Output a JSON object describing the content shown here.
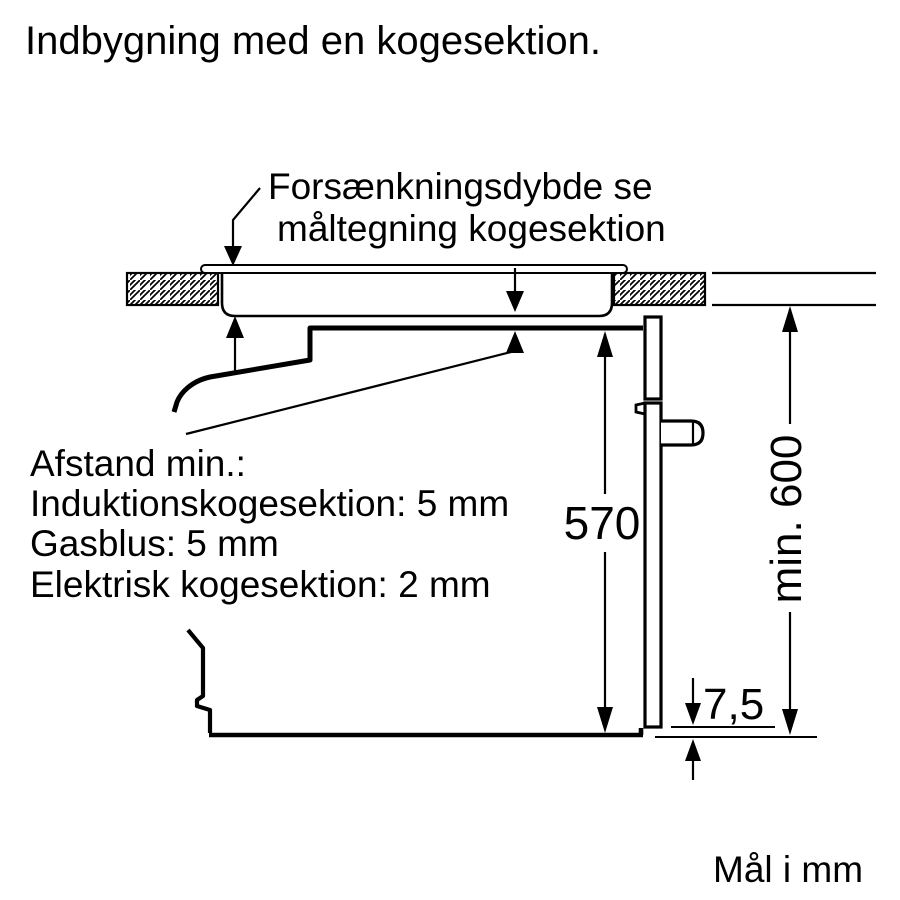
{
  "title": "Indbygning med en kogesektion.",
  "diagram": {
    "callout_recess": {
      "line1": "Forsænkningsdybde se",
      "line2": "måltegning kogesektion"
    },
    "clearance_note": {
      "line1": "Afstand min.:",
      "line2": "Induktionskogesektion: 5 mm",
      "line3": "Gasblus: 5 mm",
      "line4": "Elektrisk kogesektion: 2 mm"
    },
    "dimensions": {
      "niche_height": "570",
      "min_height": "min. 600",
      "door_gap": "7,5"
    },
    "units_note": "Mål i mm"
  },
  "colors": {
    "background": "#ffffff",
    "diagram_line": "#000000"
  }
}
